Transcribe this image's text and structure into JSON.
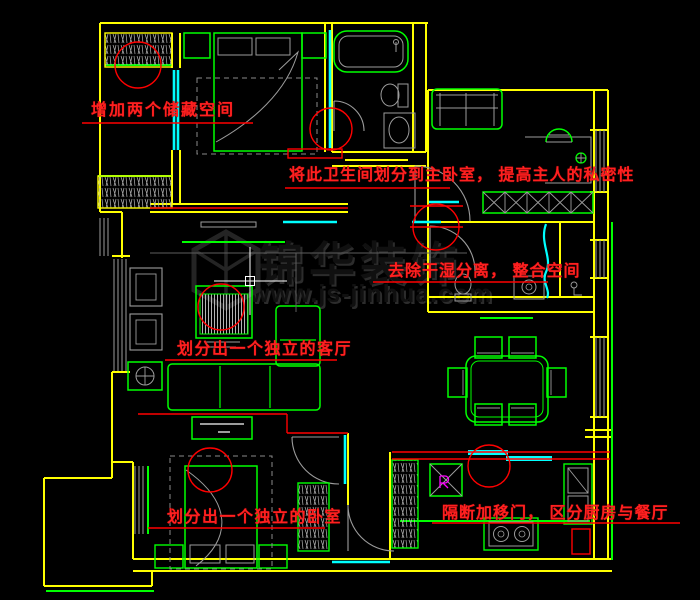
{
  "watermark": {
    "brand_text": "锦华装饰",
    "url_text": "www.js-jinhua.com"
  },
  "annotations": [
    {
      "id": "note-storage",
      "text": "增加两个储藏空间"
    },
    {
      "id": "note-master-bath",
      "text": "将此卫生间划分到主卧室， 提高主人的私密性"
    },
    {
      "id": "note-wet-dry",
      "text": "去除干湿分离， 整合空间"
    },
    {
      "id": "note-living-room",
      "text": "划分出一个独立的客厅"
    },
    {
      "id": "note-bedroom",
      "text": "划分出一个独立的卧室"
    },
    {
      "id": "note-kitchen-dining",
      "text": "隔断加移门， 区分厨房与餐厅"
    }
  ],
  "cursor": {
    "type": "crosshair",
    "x": 250,
    "y": 281
  },
  "palette": {
    "background": "#000000",
    "wall": "#ffff00",
    "furniture": "#00ff00",
    "glazing": "#00ffff",
    "markup": "#ff0000",
    "detail_gray": "#9c9c9c",
    "symbol_magenta": "#ff00ff",
    "watermark": "#101010",
    "cursor": "#ffffff"
  }
}
